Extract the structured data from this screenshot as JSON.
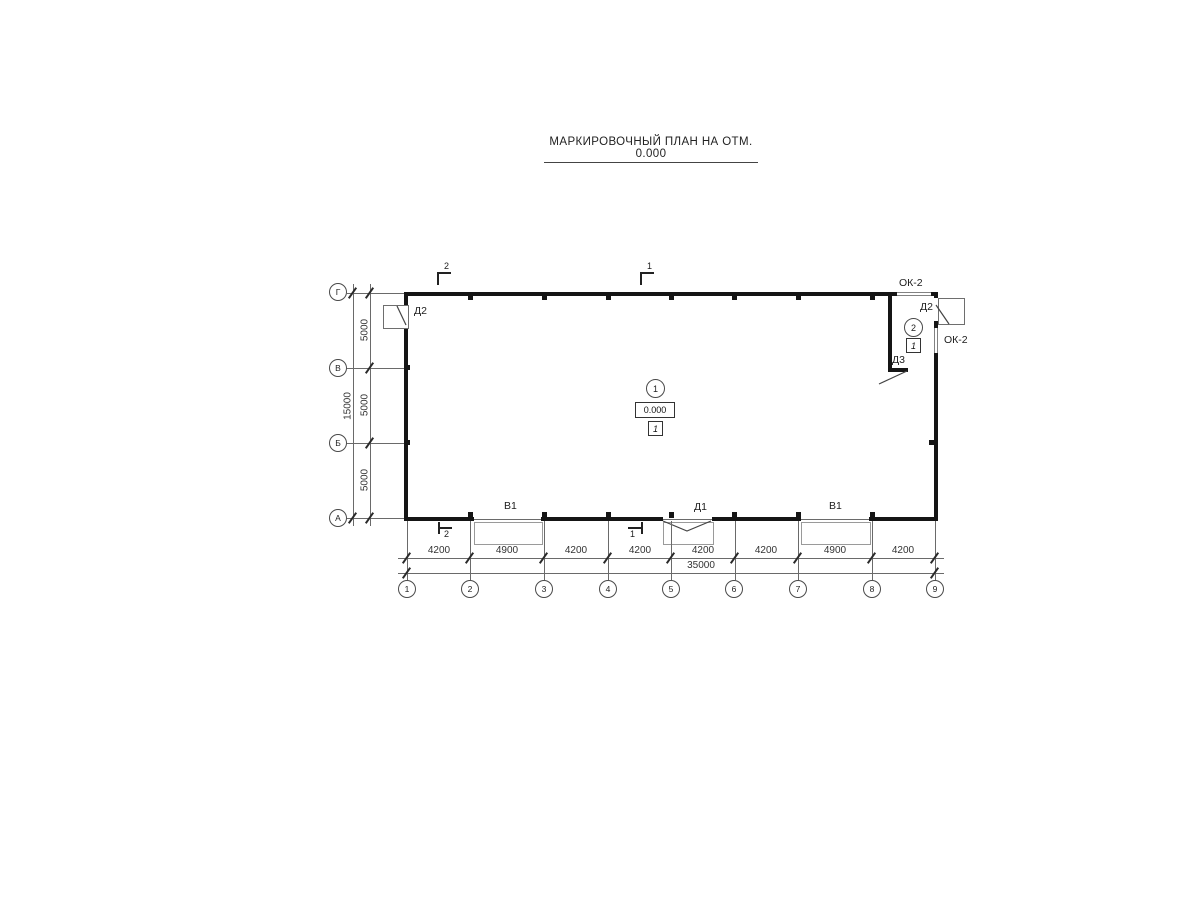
{
  "title": "МАРКИРОВОЧНЫЙ ПЛАН НА ОТМ. 0.000",
  "grid": {
    "columns": [
      "1",
      "2",
      "3",
      "4",
      "5",
      "6",
      "7",
      "8",
      "9"
    ],
    "rows": [
      "Г",
      "В",
      "Б",
      "А"
    ]
  },
  "dimensions": {
    "bottom_segments": [
      "4200",
      "4900",
      "4200",
      "4200",
      "4200",
      "4200",
      "4900",
      "4200"
    ],
    "bottom_total": "35000",
    "left_segments": [
      "5000",
      "5000",
      "5000"
    ],
    "left_total": "15000"
  },
  "labels": {
    "gate_left": "В1",
    "gate_right": "В1",
    "door_bottom": "Д1",
    "door_left": "Д2",
    "door_right": "Д2",
    "door_inner": "Д3",
    "window_top": "ОК-2",
    "window_right": "ОК-2"
  },
  "section_marks": {
    "top_left": "2",
    "top_right": "1",
    "bottom_left": "2",
    "bottom_right": "1"
  },
  "rooms": {
    "room1": {
      "number": "1",
      "elevation": "0.000",
      "floor_type": "1"
    },
    "room2": {
      "number": "2",
      "floor_type": "1"
    }
  },
  "colors": {
    "wall": "#151515",
    "thin_line": "#6a6a6a",
    "text": "#222222"
  }
}
